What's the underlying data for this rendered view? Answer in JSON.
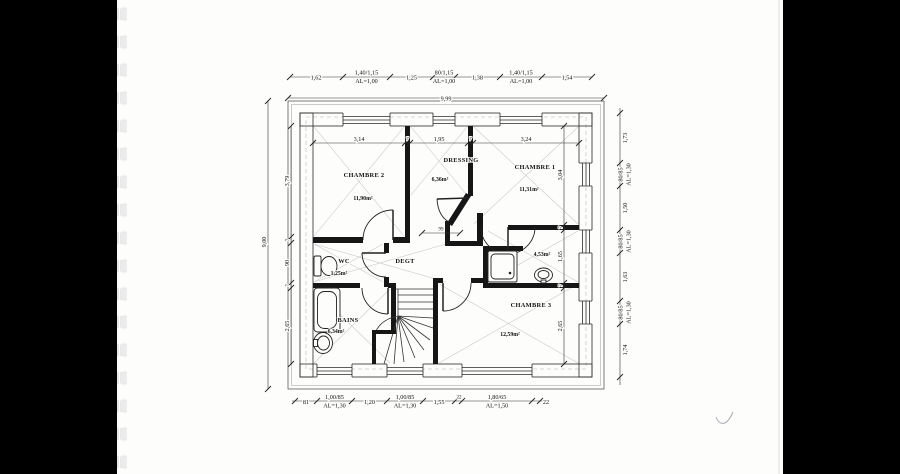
{
  "scan": {
    "left_bar_color": "#000000",
    "right_bar_color": "#000000",
    "paper_color": "#fdfdfc",
    "ink_color": "#1a1a1a"
  },
  "rooms": {
    "chambre2": {
      "name": "CHAMBRE 2",
      "area": "11,90m²"
    },
    "dressing": {
      "name": "DRESSING",
      "area": "6,36m²"
    },
    "chambre1": {
      "name": "CHAMBRE 1",
      "area": "11,31m²"
    },
    "wc": {
      "name": "WC",
      "area": "1,25m²"
    },
    "degagement": {
      "name": "DEGT"
    },
    "salle_eau": {
      "area": "4,53m²"
    },
    "bains": {
      "name": "BAINS",
      "area": "6,34m²"
    },
    "chambre3": {
      "name": "CHAMBRE 3",
      "area": "12,59m²"
    }
  },
  "dims": {
    "top": {
      "seg1": "1,62",
      "win1": "1,40/1,15",
      "win1_al": "AL=1,00",
      "seg2": "1,25",
      "win2": "80/1,15",
      "win2_al": "AL=1,00",
      "seg3": "1,38",
      "win3": "1,40/1,15",
      "win3_al": "AL=1,00",
      "seg4": "1,54",
      "total": "9,99"
    },
    "bottom": {
      "seg1": "81",
      "win1": "1,00/85",
      "win1_al": "AL=1,30",
      "seg2": "1,20",
      "win2": "1,00/85",
      "win2_al": "AL=1,30",
      "seg3": "1,55",
      "seg4": "22",
      "win3": "1,80/65",
      "win3_al": "AL=1,50",
      "seg5": "22"
    },
    "right": {
      "seg1": "1,73",
      "win1": "80/85",
      "win1_al": "AL=1,30",
      "seg2": "1,50",
      "win2": "80/85",
      "win2_al": "AL=1,30",
      "seg3": "1,63",
      "win3": "80/85",
      "win3_al": "AL=1,30",
      "seg4": "1,74",
      "total": "9,00"
    },
    "inner_top": {
      "d1": "3,14",
      "d2": "7",
      "d3": "1,95",
      "d4": "7",
      "d5": "3,24"
    },
    "inner_left": {
      "d1": "3,79",
      "d2": "7",
      "d3": "90",
      "d4": "7",
      "d5": "2,65"
    },
    "inner_right": {
      "d1": "3,04",
      "d2": "7",
      "d3": "1,65",
      "d4": "7",
      "d5": "2,65"
    },
    "opening": "99"
  }
}
